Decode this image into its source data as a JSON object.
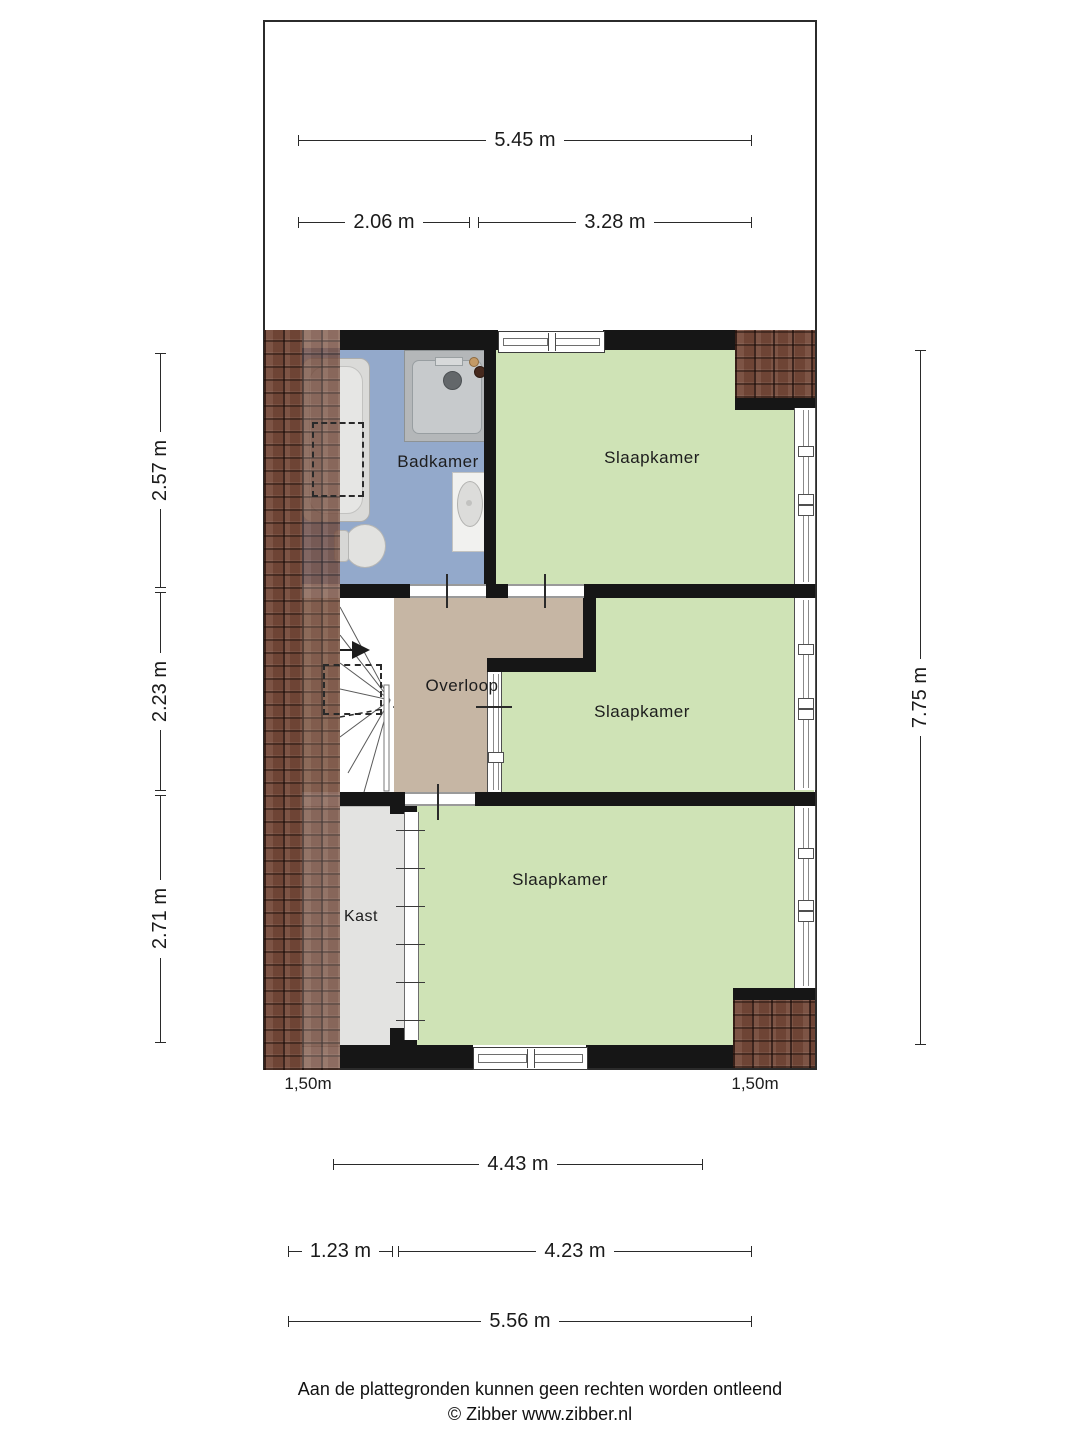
{
  "rooms": [
    {
      "id": "badkamer",
      "label": "Badkamer"
    },
    {
      "id": "slaapkamer-1",
      "label": "Slaapkamer"
    },
    {
      "id": "overloop",
      "label": "Overloop"
    },
    {
      "id": "slaapkamer-2",
      "label": "Slaapkamer"
    },
    {
      "id": "kast",
      "label": "Kast"
    },
    {
      "id": "slaapkamer-3",
      "label": "Slaapkamer"
    }
  ],
  "dimensions": {
    "top": [
      {
        "label": "5.45 m"
      },
      {
        "label": "2.06 m"
      },
      {
        "label": "3.28 m"
      }
    ],
    "left": [
      {
        "label": "2.57 m"
      },
      {
        "label": "2.23 m"
      },
      {
        "label": "2.71 m"
      }
    ],
    "right": [
      {
        "label": "7.75 m"
      }
    ],
    "bottom": [
      {
        "label": "4.43 m"
      },
      {
        "label": "1.23 m"
      },
      {
        "label": "4.23 m"
      },
      {
        "label": "5.56 m"
      }
    ],
    "eaves": [
      {
        "label": "1,50m"
      },
      {
        "label": "1,50m"
      }
    ]
  },
  "fixtures": [
    {
      "name": "bathtub"
    },
    {
      "name": "shower"
    },
    {
      "name": "sink"
    },
    {
      "name": "toilet"
    },
    {
      "name": "stairs"
    },
    {
      "name": "wardrobe-folding-door"
    }
  ],
  "footer": {
    "disclaimer": "Aan de plattegronden kunnen geen rechten worden ontleend",
    "credit": "© Zibber www.zibber.nl"
  },
  "colors": {
    "bathroom": "#93a9cb",
    "bedroom": "#cfe3b6",
    "hall": "#c6b6a4",
    "closet": "#e3e3e1",
    "roof": "#6e4435",
    "wall": "#161616",
    "line": "#2a2a2a",
    "label": "#1c1c1c"
  }
}
